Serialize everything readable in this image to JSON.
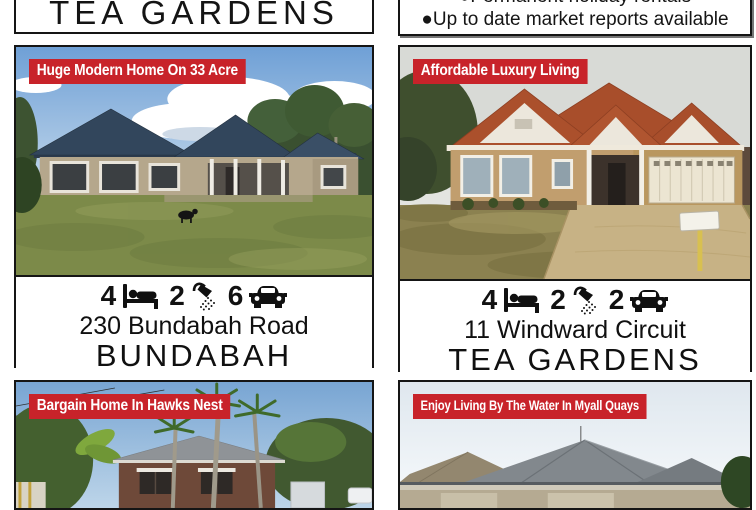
{
  "colors": {
    "banner_bg": "#c8232a",
    "banner_text": "#ffffff",
    "border": "#151515"
  },
  "header": {
    "left_box": {
      "title": "TEA GARDENS"
    },
    "right_box": {
      "bullet_char": "●",
      "bullets": [
        "Permanent holiday rentals",
        "Up to date market reports available"
      ]
    }
  },
  "listings": [
    {
      "banner": "Huge Modern Home On 33 Acre",
      "beds": "4",
      "baths": "2",
      "cars": "6",
      "address": "230 Bundabah Road",
      "suburb": "BUNDABAH",
      "photo": "brick home with dark roof on large lawn, blue sky with clouds",
      "stat_icons": [
        "bed",
        "shower",
        "car"
      ]
    },
    {
      "banner": "Affordable Luxury Living",
      "beds": "4",
      "baths": "2",
      "cars": "2",
      "address": "11 Windward Circuit",
      "suburb": "TEA GARDENS",
      "photo": "terracotta-roof brick home with double garage and driveway",
      "stat_icons": [
        "bed",
        "shower",
        "car"
      ]
    },
    {
      "banner": "Bargain Home In Hawks Nest",
      "photo": "brick cottage behind palm trees, blue sky"
    },
    {
      "banner": "Enjoy Living By The Water In Myall Quays",
      "photo": "grey rooftops against pale sky"
    }
  ]
}
